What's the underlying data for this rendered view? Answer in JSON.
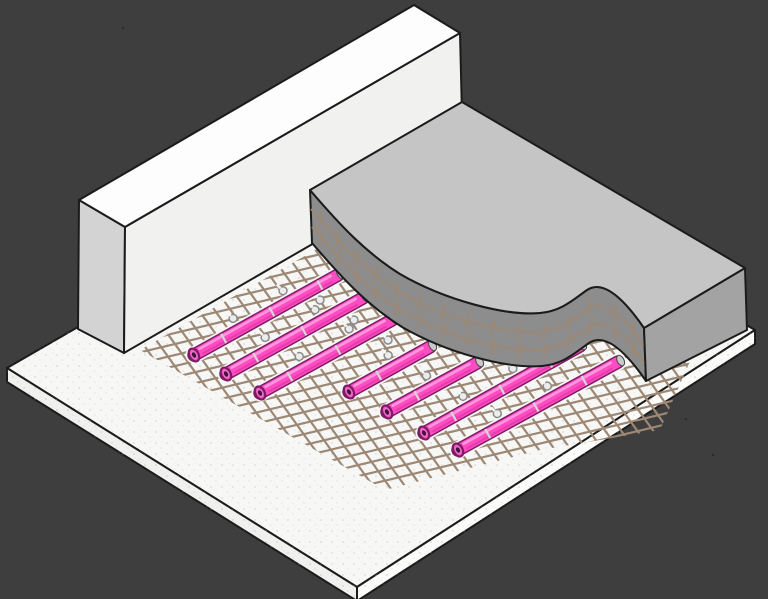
{
  "scene": {
    "title": "Isometric cutaway: underfloor heating pipes on reinforcement mesh between wall and screed",
    "canvas": {
      "width": 768,
      "height": 599
    },
    "colors": {
      "background": "#3e3e3e",
      "outline": "#1b1b1b",
      "slab_top": "#f7f7f5",
      "slab_left": "#f0f0ee",
      "slab_right": "#fbfbf9",
      "speckle": "#b9b9b9",
      "wall_top": "#fdfdfd",
      "wall_left": "#d3d3d3",
      "wall_front": "#f1f1f0",
      "screed_top": "#c5c5c6",
      "screed_cut": "#8d8d8e",
      "screed_right": "#a3a3a4",
      "mesh": "#9c8874",
      "pipe_body": "#ff4cc4",
      "pipe_outline": "#7c1b63",
      "pipe_highlight": "#ff9ade",
      "pipe_shade": "#e1379f",
      "pipe_ring": "#d6d6d6",
      "pipe_tip": "#c9c9c9",
      "pipe_hole": "#4a1040",
      "pipe_rim": "#df77c2",
      "clip_fill": "#ececec",
      "clip_stroke": "#8a8a8a",
      "speck": "#2c2c2c"
    },
    "slab": {
      "top": [
        [
          7,
          368
        ],
        [
          414,
          133
        ],
        [
          755,
          330
        ],
        [
          357,
          587
        ]
      ],
      "front_left": [
        [
          7,
          368
        ],
        [
          357,
          587
        ],
        [
          357,
          601
        ],
        [
          7,
          382
        ]
      ],
      "front_right": [
        [
          357,
          587
        ],
        [
          755,
          330
        ],
        [
          755,
          344
        ],
        [
          357,
          601
        ]
      ]
    },
    "wall": {
      "top": [
        [
          79,
          200
        ],
        [
          414,
          5
        ],
        [
          460,
          33
        ],
        [
          125,
          227
        ]
      ],
      "left_end": [
        [
          79,
          200
        ],
        [
          125,
          227
        ],
        [
          124,
          353
        ],
        [
          78,
          329
        ]
      ],
      "front": [
        [
          125,
          227
        ],
        [
          460,
          33
        ],
        [
          463,
          157
        ],
        [
          124,
          353
        ]
      ]
    },
    "mesh": {
      "clip": [
        [
          140,
          350
        ],
        [
          452,
          172
        ],
        [
          708,
          320
        ],
        [
          660,
          430
        ],
        [
          540,
          450
        ],
        [
          385,
          490
        ]
      ],
      "shallow": {
        "c_min": 276,
        "c_max": 640,
        "step": 11,
        "slope": 0.2397,
        "x1": 70,
        "x2": 762
      },
      "steep": {
        "c_min": -120,
        "c_max": 500,
        "step": 16,
        "inv_slope": 0.7179,
        "y1": 140,
        "y2": 520
      },
      "stroke_width": 2.2
    },
    "pipes": {
      "items": [
        {
          "x1": 194,
          "y1": 355,
          "x2": 338,
          "y2": 275
        },
        {
          "x1": 226,
          "y1": 374,
          "x2": 363,
          "y2": 298
        },
        {
          "x1": 260,
          "y1": 393,
          "x2": 392,
          "y2": 320
        },
        {
          "x1": 349,
          "y1": 392,
          "x2": 430,
          "y2": 347
        },
        {
          "x1": 387,
          "y1": 412,
          "x2": 477,
          "y2": 363
        },
        {
          "x1": 424,
          "y1": 433,
          "x2": 580,
          "y2": 346
        },
        {
          "x1": 458,
          "y1": 450,
          "x2": 618,
          "y2": 362
        }
      ],
      "widths": {
        "halo": 17,
        "outline": 13.5,
        "body": 10.5,
        "highlight": 2.8,
        "shade": 2
      },
      "ring_start": 34,
      "ring_step": 55,
      "clip_start": 52,
      "clip_step": 57,
      "clip_offset": 13
    },
    "screed": {
      "top_edge": {
        "start": [
          310,
          190
        ],
        "segments": [
          [
            340,
            225,
            365,
            252,
            400,
            274
          ],
          [
            445,
            300,
            505,
            316,
            540,
            313
          ],
          [
            562,
            311,
            574,
            299,
            587,
            290
          ],
          [
            602,
            280,
            622,
            296,
            644,
            328
          ]
        ]
      },
      "thickness_offset": [
        2,
        53
      ],
      "wall_corner": [
        462,
        102
      ],
      "top_right_corner": [
        745,
        268
      ],
      "right_face": [
        [
          644,
          328
        ],
        [
          745,
          268
        ],
        [
          747,
          330
        ],
        [
          646,
          381
        ]
      ],
      "ladder_offsets": [
        [
          1,
          19
        ],
        [
          2,
          37
        ]
      ],
      "ladder_tick_spacing": 26
    },
    "extra_clips": [
      [
        320,
        300
      ],
      [
        354,
        320
      ],
      [
        388,
        340
      ],
      [
        422,
        358
      ]
    ],
    "specks": [
      [
        123,
        28
      ],
      [
        686,
        419
      ],
      [
        713,
        455
      ]
    ]
  }
}
